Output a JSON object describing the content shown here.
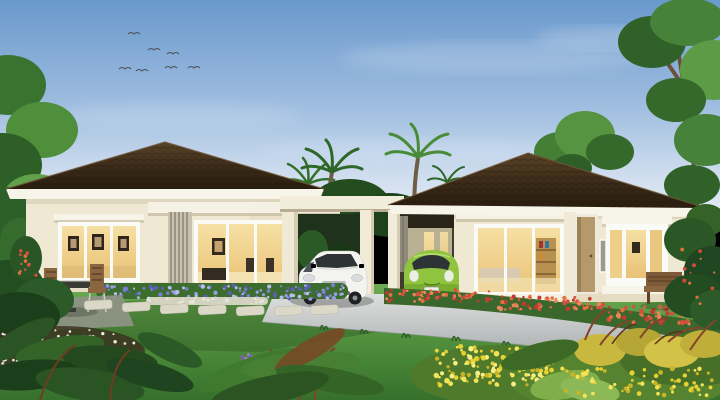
{
  "scene": {
    "objects": [
      "sky-with-birds",
      "background-trees",
      "palm-trees",
      "left-house",
      "right-house",
      "double-carport",
      "white-hatchback-car",
      "green-compact-car",
      "lawn",
      "driveway",
      "stepping-stones",
      "patio-table-set",
      "garden-benches",
      "purple-flower-bed",
      "red-flower-hedge",
      "yellow-flower-garden",
      "foreground-tropical-plants"
    ]
  },
  "palette": {
    "wall": "#efe8d3",
    "wall_shade": "#e3d8bd",
    "plinth": "#e5dcc3",
    "fascia": "#f7f4e9",
    "porch": "#f5f1e4",
    "canopy_shadow": "#c9c0a6",
    "frame": "#fafaf6",
    "louver": "#c9c2b1",
    "louver_line": "#7d7668",
    "paver": "#dcd8c7",
    "hedge_green": "#3a672c",
    "bed_green": "#3d6d2e",
    "car_white": "#f3f3f0",
    "car_glass": "#2e3436",
    "car_green": "#8fc43e",
    "car_green_dark": "#699f2b",
    "wood": "#8a6540",
    "wood_dark": "#5d4228",
    "metal": "#c9cdc9",
    "trunk": "#6b5138",
    "soil": "#3a2f1e"
  },
  "sky": {
    "birds": [
      [
        128,
        34
      ],
      [
        148,
        50
      ],
      [
        167,
        54
      ],
      [
        119,
        69
      ],
      [
        136,
        71
      ],
      [
        165,
        68
      ],
      [
        188,
        68
      ]
    ]
  },
  "garden": {
    "stepping_stones": [
      [
        84,
        301
      ],
      [
        122,
        303
      ],
      [
        160,
        305
      ],
      [
        198,
        306
      ],
      [
        236,
        307
      ],
      [
        274,
        307
      ],
      [
        310,
        306
      ]
    ],
    "flower_patches": [
      {
        "id": "purple-bed",
        "rect": [
          100,
          285,
          244,
          14
        ],
        "colors": [
          "#7b7ecf",
          "#989ddd",
          "#5a60b8",
          "#b8bce8"
        ],
        "count": 120,
        "radius": 1.6
      },
      {
        "id": "pebble-strip",
        "rect": [
          148,
          298,
          118,
          6
        ],
        "colors": [
          "#e8e5d8",
          "#d6d3c2"
        ],
        "count": 45,
        "radius": 1.4
      },
      {
        "id": "red-hedge-a",
        "rect": [
          386,
          290,
          110,
          12
        ],
        "colors": [
          "#d4503f",
          "#e2713f",
          "#c23b32",
          "#e8865c"
        ],
        "count": 60,
        "radius": 1.6
      },
      {
        "id": "red-hedge-b",
        "rect": [
          496,
          296,
          112,
          14
        ],
        "colors": [
          "#d4503f",
          "#e2713f",
          "#c23b32",
          "#e8865c"
        ],
        "count": 62,
        "radius": 1.7
      },
      {
        "id": "red-hedge-c",
        "rect": [
          608,
          306,
          112,
          18
        ],
        "colors": [
          "#d4503f",
          "#e2713f",
          "#c23b32",
          "#e8865c"
        ],
        "count": 66,
        "radius": 1.9
      },
      {
        "id": "yellow-a",
        "rect": [
          436,
          346,
          120,
          40
        ],
        "colors": [
          "#e6d232",
          "#f2e358",
          "#c9b428",
          "#f7ee86"
        ],
        "count": 130,
        "radius": 2
      },
      {
        "id": "yellow-b",
        "rect": [
          562,
          368,
          150,
          28
        ],
        "colors": [
          "#e6d232",
          "#f2e358",
          "#c9b428"
        ],
        "count": 70,
        "radius": 1.9
      },
      {
        "id": "white-ground",
        "rect": [
          2,
          330,
          132,
          40
        ],
        "colors": [
          "#eae8db",
          "#d9d8c8",
          "#f2f1e6"
        ],
        "count": 80,
        "radius": 1.4
      },
      {
        "id": "purple-fg",
        "rect": [
          240,
          354,
          64,
          24
        ],
        "colors": [
          "#9a7fc0",
          "#b394d4",
          "#7d5fa8"
        ],
        "count": 45,
        "radius": 1.7
      },
      {
        "id": "red-left",
        "rect": [
          16,
          246,
          20,
          32
        ],
        "colors": [
          "#d4503f",
          "#e2713f"
        ],
        "count": 14,
        "radius": 1.5
      },
      {
        "id": "red-right-bush",
        "rect": [
          676,
          248,
          40,
          56
        ],
        "colors": [
          "#cf4a3a",
          "#e2713f"
        ],
        "count": 12,
        "radius": 1.5
      }
    ]
  }
}
